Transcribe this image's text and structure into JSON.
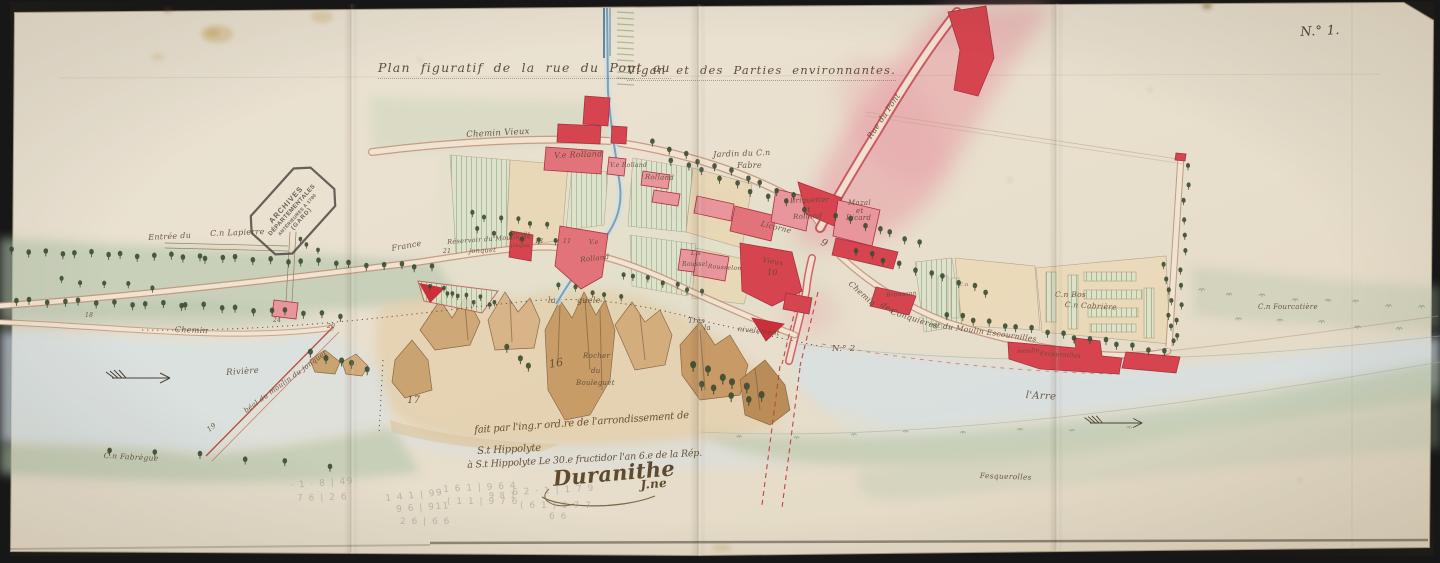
{
  "map": {
    "sheet_number": "N.° 1.",
    "title_left": "Plan figuratif de la rue du Pont au",
    "title_right": "Vigan et des Parties environnantes.",
    "stamp": {
      "lines": [
        "ARCHIVES",
        "DÉPARTEMENTALES",
        "ANTÉRIEURES À 1790",
        "(GARD)"
      ]
    },
    "note": {
      "line1": "fait par l'ing.r ord.re de l'arrondissement de",
      "line2": "S.t Hippolyte",
      "line3": "à S.t Hippolyte Le 30.e fructidor l'an 6.e de la Rép.",
      "signature": "Duranithe",
      "signature_suffix": "J.ne"
    },
    "colors": {
      "paper": "#eae2d1",
      "ink": "#5d4a35",
      "building_red": "#d6454f",
      "building_pink": "#e8959b",
      "pink_wash": "#e795a0",
      "green_wash": "#b3c4aa",
      "water": "#d4e1e6",
      "pencil": "#97918a"
    },
    "labels": [
      {
        "t": "Chemin Vieux",
        "x": 466,
        "y": 131,
        "r": -3,
        "s": 8.5,
        "c": ""
      },
      {
        "t": "V.e Rolland",
        "x": 554,
        "y": 152,
        "r": -2,
        "s": 8,
        "c": ""
      },
      {
        "t": "Jardin du C.n",
        "x": 713,
        "y": 151,
        "r": -2,
        "s": 8,
        "c": ""
      },
      {
        "t": "Fabre",
        "x": 737,
        "y": 162,
        "r": 0,
        "s": 8,
        "c": ""
      },
      {
        "t": "V.e Rolland",
        "x": 610,
        "y": 163,
        "r": 0,
        "s": 6,
        "c": ""
      },
      {
        "t": "Rolland",
        "x": 645,
        "y": 174,
        "r": 2,
        "s": 7,
        "c": ""
      },
      {
        "t": "Briquetier",
        "x": 790,
        "y": 198,
        "r": -2,
        "s": 7,
        "c": ""
      },
      {
        "t": "et",
        "x": 803,
        "y": 207,
        "r": 0,
        "s": 7,
        "c": ""
      },
      {
        "t": "Rolland",
        "x": 793,
        "y": 214,
        "r": -2,
        "s": 7,
        "c": ""
      },
      {
        "t": "Mazal",
        "x": 848,
        "y": 200,
        "r": 0,
        "s": 7,
        "c": ""
      },
      {
        "t": "et",
        "x": 856,
        "y": 208,
        "r": 0,
        "s": 7,
        "c": ""
      },
      {
        "t": "Ricard",
        "x": 846,
        "y": 215,
        "r": 0,
        "s": 7,
        "c": ""
      },
      {
        "t": "Rue du Pont",
        "x": 866,
        "y": 136,
        "r": -56,
        "s": 8,
        "c": ""
      },
      {
        "t": "Licorne",
        "x": 762,
        "y": 220,
        "r": 14,
        "s": 7.5,
        "c": ""
      },
      {
        "t": "V.e",
        "x": 589,
        "y": 240,
        "r": 0,
        "s": 6,
        "c": ""
      },
      {
        "t": "Rolland",
        "x": 580,
        "y": 257,
        "r": -6,
        "s": 7,
        "c": ""
      },
      {
        "t": "L.s",
        "x": 691,
        "y": 251,
        "r": 0,
        "s": 6,
        "c": ""
      },
      {
        "t": "Roussel",
        "x": 682,
        "y": 262,
        "r": 0,
        "s": 6,
        "c": ""
      },
      {
        "t": "Rousselon",
        "x": 708,
        "y": 264,
        "r": 4,
        "s": 6,
        "c": ""
      },
      {
        "t": "Vieux",
        "x": 763,
        "y": 257,
        "r": 10,
        "s": 7,
        "c": ""
      },
      {
        "t": "10",
        "x": 767,
        "y": 269,
        "r": 0,
        "s": 8,
        "c": ""
      },
      {
        "t": "Moulin",
        "x": 513,
        "y": 233,
        "r": 0,
        "s": 4.5,
        "c": ""
      },
      {
        "t": "du",
        "x": 519,
        "y": 239,
        "r": 0,
        "s": 4.5,
        "c": ""
      },
      {
        "t": "jonquet",
        "x": 511,
        "y": 245,
        "r": 0,
        "s": 4.5,
        "c": ""
      },
      {
        "t": "Réservoir du Moulin du",
        "x": 447,
        "y": 239,
        "r": -4,
        "s": 6.5,
        "c": ""
      },
      {
        "t": "jonquet",
        "x": 469,
        "y": 248,
        "r": -2,
        "s": 6.5,
        "c": ""
      },
      {
        "t": "France",
        "x": 391,
        "y": 245,
        "r": -10,
        "s": 8,
        "c": ""
      },
      {
        "t": "Entrée du",
        "x": 148,
        "y": 234,
        "r": -3,
        "s": 8,
        "c": ""
      },
      {
        "t": "C.n Lapierre",
        "x": 210,
        "y": 230,
        "r": -2,
        "s": 8,
        "c": ""
      },
      {
        "t": "Chemin",
        "x": 175,
        "y": 326,
        "r": 2,
        "s": 8,
        "c": ""
      },
      {
        "t": "Rivière",
        "x": 226,
        "y": 369,
        "r": -4,
        "s": 8.5,
        "c": ""
      },
      {
        "t": "béal du moulin du jonquet",
        "x": 243,
        "y": 409,
        "r": -36,
        "s": 7,
        "c": ""
      },
      {
        "t": "C.n Fabrègue",
        "x": 104,
        "y": 452,
        "r": 3,
        "s": 7.5,
        "c": ""
      },
      {
        "t": "la",
        "x": 548,
        "y": 297,
        "r": 0,
        "s": 8,
        "c": ""
      },
      {
        "t": "guele",
        "x": 577,
        "y": 297,
        "r": 0,
        "s": 8,
        "c": ""
      },
      {
        "t": "Très",
        "x": 688,
        "y": 318,
        "r": 0,
        "s": 7,
        "c": ""
      },
      {
        "t": "la",
        "x": 704,
        "y": 325,
        "r": 0,
        "s": 7,
        "c": ""
      },
      {
        "t": "nivelement",
        "x": 738,
        "y": 326,
        "r": 6,
        "s": 7,
        "c": ""
      },
      {
        "t": "Chemin",
        "x": 852,
        "y": 280,
        "r": 42,
        "s": 8,
        "c": ""
      },
      {
        "t": "des",
        "x": 883,
        "y": 301,
        "r": 30,
        "s": 8,
        "c": ""
      },
      {
        "t": "Conquières",
        "x": 892,
        "y": 308,
        "r": 18,
        "s": 8,
        "c": ""
      },
      {
        "t": "et du Moulin Escournilles",
        "x": 933,
        "y": 321,
        "r": 8,
        "s": 7.5,
        "c": ""
      },
      {
        "t": "Brousson",
        "x": 886,
        "y": 293,
        "r": -4,
        "s": 6,
        "c": ""
      },
      {
        "t": "C.n",
        "x": 959,
        "y": 283,
        "r": 0,
        "s": 5,
        "c": ""
      },
      {
        "t": "C.n Bos",
        "x": 1055,
        "y": 291,
        "r": 0,
        "s": 7.5,
        "c": ""
      },
      {
        "t": "C.n Cabrière",
        "x": 1065,
        "y": 301,
        "r": 3,
        "s": 7.5,
        "c": ""
      },
      {
        "t": "moulin",
        "x": 1017,
        "y": 349,
        "r": -2,
        "s": 6,
        "c": ""
      },
      {
        "t": "Escournilles",
        "x": 1040,
        "y": 351,
        "r": 4,
        "s": 6,
        "c": ""
      },
      {
        "t": "l'Arre",
        "x": 1026,
        "y": 391,
        "r": 3,
        "s": 10,
        "c": ""
      },
      {
        "t": "C.n Fourcatière",
        "x": 1258,
        "y": 304,
        "r": 0,
        "s": 7,
        "c": ""
      },
      {
        "t": "Fesquerolles",
        "x": 980,
        "y": 472,
        "r": 2,
        "s": 7.5,
        "c": ""
      },
      {
        "t": "Rocher",
        "x": 583,
        "y": 353,
        "r": 0,
        "s": 7,
        "c": ""
      },
      {
        "t": "du",
        "x": 591,
        "y": 368,
        "r": 0,
        "s": 7,
        "c": ""
      },
      {
        "t": "Bouleguet",
        "x": 576,
        "y": 380,
        "r": 0,
        "s": 7,
        "c": ""
      },
      {
        "t": "16",
        "x": 548,
        "y": 359,
        "r": -10,
        "s": 11,
        "c": ""
      },
      {
        "t": "17",
        "x": 407,
        "y": 396,
        "r": 0,
        "s": 10,
        "c": ""
      },
      {
        "t": "N.° 2",
        "x": 832,
        "y": 345,
        "r": 0,
        "s": 8.5,
        "c": ""
      },
      {
        "t": "9",
        "x": 823,
        "y": 238,
        "r": 25,
        "s": 10,
        "c": ""
      },
      {
        "t": "13",
        "x": 535,
        "y": 239,
        "r": 0,
        "s": 6,
        "c": ""
      },
      {
        "t": "11",
        "x": 563,
        "y": 239,
        "r": 0,
        "s": 6,
        "c": ""
      },
      {
        "t": "21",
        "x": 443,
        "y": 249,
        "r": 0,
        "s": 6,
        "c": ""
      },
      {
        "t": "24",
        "x": 273,
        "y": 318,
        "r": 0,
        "s": 6,
        "c": ""
      },
      {
        "t": "20",
        "x": 327,
        "y": 324,
        "r": 0,
        "s": 6,
        "c": ""
      },
      {
        "t": "19",
        "x": 206,
        "y": 428,
        "r": -38,
        "s": 7,
        "c": ""
      },
      {
        "t": "18",
        "x": 85,
        "y": 313,
        "r": 0,
        "s": 6,
        "c": ""
      },
      {
        "t": "· 1 · 8 | 49",
        "x": 290,
        "y": 482,
        "r": -4,
        "s": 9,
        "c": "pencil"
      },
      {
        "t": "7 6 | 2 6",
        "x": 297,
        "y": 495,
        "r": -2,
        "s": 9,
        "c": "pencil"
      },
      {
        "t": "1 4 1 | 99",
        "x": 385,
        "y": 495,
        "r": -6,
        "s": 9,
        "c": "pencil"
      },
      {
        "t": "9 6 | 911",
        "x": 396,
        "y": 506,
        "r": -4,
        "s": 9,
        "c": "pencil"
      },
      {
        "t": "2 6 | 6 6",
        "x": 400,
        "y": 518,
        "r": 0,
        "s": 9,
        "c": "pencil"
      },
      {
        "t": "1 6 1 | 9 6 4",
        "x": 443,
        "y": 486,
        "r": -3,
        "s": 9,
        "c": "pencil"
      },
      {
        "t": "( 1 1 | 9 7 6",
        "x": 447,
        "y": 498,
        "r": 0,
        "s": 9,
        "c": "pencil"
      },
      {
        "t": "9 8 1",
        "x": 489,
        "y": 492,
        "r": 0,
        "s": 8,
        "c": "pencil"
      },
      {
        "t": "6 2 · 1 | 1 7 9",
        "x": 512,
        "y": 489,
        "r": -3,
        "s": 9,
        "c": "pencil"
      },
      {
        "t": "( 6 1 )  0 7 7",
        "x": 520,
        "y": 502,
        "r": 0,
        "s": 9,
        "c": "pencil"
      },
      {
        "t": "6 6",
        "x": 549,
        "y": 513,
        "r": 0,
        "s": 9,
        "c": "pencil"
      }
    ]
  }
}
